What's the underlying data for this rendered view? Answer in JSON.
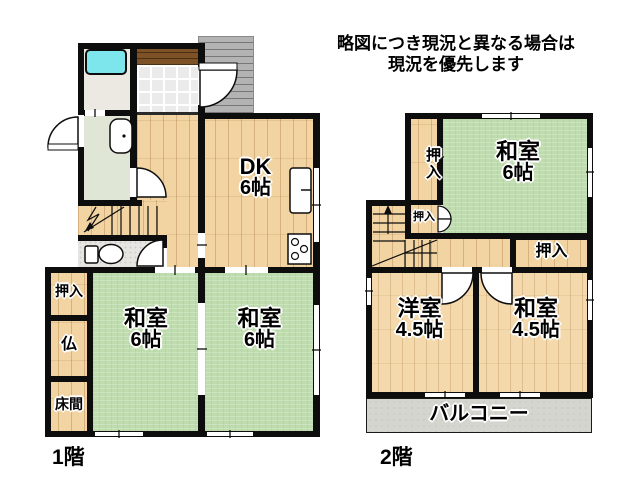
{
  "disclaimer": {
    "line1": "略図につき現況と異なる場合は",
    "line2": "現況を優先します"
  },
  "floor1": {
    "label": "1階",
    "dk": {
      "name": "DK",
      "size": "6帖"
    },
    "washitsu_left": {
      "name": "和室",
      "size": "6帖"
    },
    "washitsu_right": {
      "name": "和室",
      "size": "6帖"
    },
    "oshiire": "押入",
    "butsuma": "仏",
    "tokonoma": "床間"
  },
  "floor2": {
    "label": "2階",
    "washitsu6": {
      "name": "和室",
      "size": "6帖"
    },
    "oshiire_upper": "押入",
    "oshiire_mid": "押入",
    "oshiire_right": "押入",
    "youshitsu": {
      "name": "洋室",
      "size": "4.5帖"
    },
    "washitsu45": {
      "name": "和室",
      "size": "4.5帖"
    },
    "balcony": "バルコニー"
  },
  "colors": {
    "wall": "#0d0d0d",
    "tatami_green": "#bedcad",
    "wood_floor": "#f2d3a2",
    "bathtub_cyan": "#7de6ec",
    "porch_gray": "#b3b3b3",
    "balcony_gray": "#d5d5d0",
    "genkan_step_brown": "#7d5226"
  }
}
